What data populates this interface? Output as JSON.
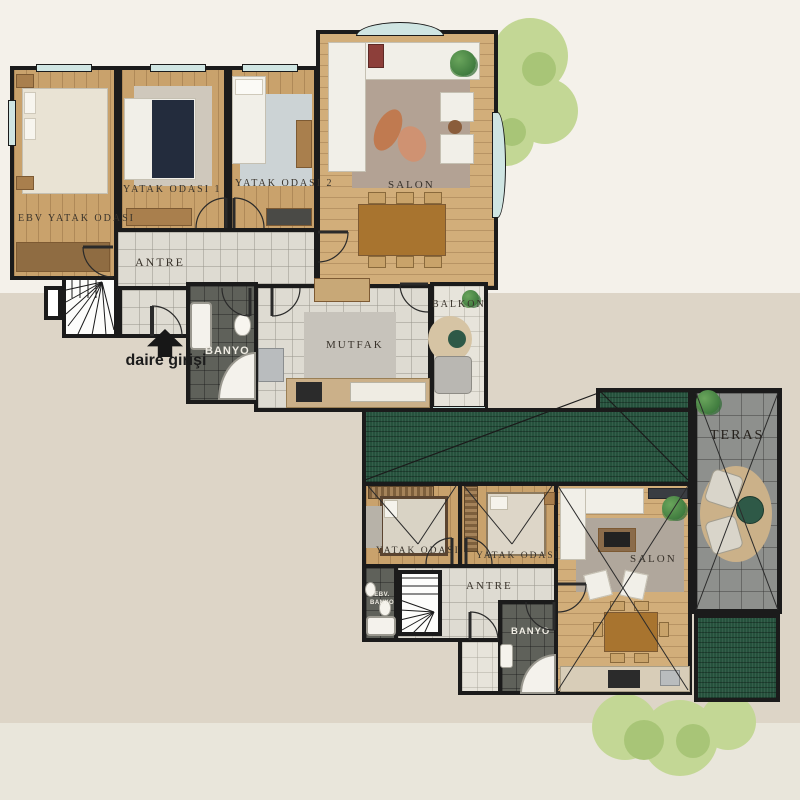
{
  "palette": {
    "bg-top": "#f4f1ea",
    "bg-mid": "#ddd5c7",
    "bg-bottom": "#e9e6db",
    "wall": "#1b1b1b",
    "wood": "#c9a26c",
    "wood-salon": "#d2ae7a",
    "tile": "#dedbd2",
    "tile-dark": "#5f615a",
    "balcony": "#e7e4db",
    "roof-green": "#26523d",
    "terrace": "#8e908d",
    "window": "#cfe5e2",
    "tree-light": "#c3d795",
    "tree-dark": "#a8c577",
    "accent-navy": "#232c3d",
    "accent-table-green": "#2e5947"
  },
  "upper_plan": {
    "rooms": [
      {
        "label": "EBV YATAK ODASI"
      },
      {
        "label": "YATAK ODASI 1"
      },
      {
        "label": "YATAK ODASI 2"
      },
      {
        "label": "SALON"
      },
      {
        "label": "ANTRE"
      },
      {
        "label": "BANYO"
      },
      {
        "label": "MUTFAK"
      },
      {
        "label": "BALKON"
      }
    ],
    "entrance_label": "daire girişi"
  },
  "lower_plan": {
    "rooms": [
      {
        "label": "YATAK ODASI"
      },
      {
        "label": "YATAK ODASI"
      },
      {
        "label": "SALON"
      },
      {
        "label": "ANTRE"
      },
      {
        "label": "EBV. BANYO"
      },
      {
        "label": "BANYO"
      },
      {
        "label": "TERAS"
      }
    ]
  }
}
